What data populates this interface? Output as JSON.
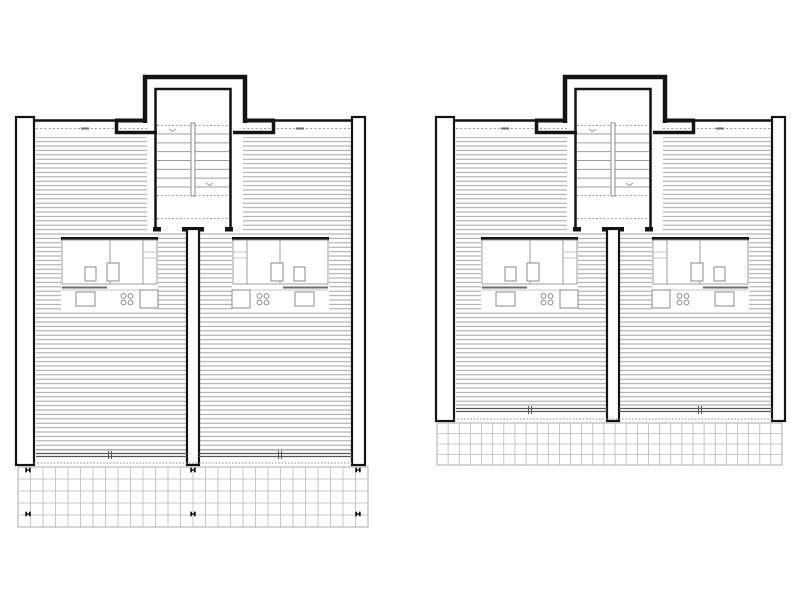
{
  "canvas": {
    "width": 800,
    "height": 600,
    "background": "#ffffff"
  },
  "colors": {
    "ink": "#141414",
    "hatch": "#989898",
    "mid": "#6e6e6e",
    "rail": "#555555",
    "light": "#c4c4c4",
    "grid": "#b9b9b9",
    "thin": "#9c9c9c",
    "fixture": "#8a8a8a",
    "white": "#ffffff"
  },
  "shared": {
    "mirror_axis": 195,
    "bar_top": 117,
    "bars": [
      {
        "x": 16,
        "w": 18
      },
      {
        "x": 352,
        "w": 13
      }
    ],
    "top_line_y": 120.5,
    "top_line_segments": [
      [
        34,
        115
      ],
      [
        275,
        352
      ]
    ],
    "shoulder": {
      "h1_y": 120.5,
      "h1": [
        [
          115,
          147
        ],
        [
          243,
          275
        ]
      ],
      "v_x": [
        116.5,
        273.5
      ],
      "v_y": [
        119,
        134
      ],
      "h2_y": 132.5,
      "h2": [
        [
          115,
          157
        ],
        [
          233,
          275
        ]
      ]
    },
    "tower": {
      "x1": 145,
      "x2": 245,
      "top": 77,
      "base": 123,
      "stroke": 4.5
    },
    "stair": {
      "x1": 155.5,
      "x2": 230.5,
      "top": 89,
      "bottom": 229,
      "tread_x1": 157,
      "tread_x2": 229,
      "tread_y1": 134,
      "tread_y2": 187,
      "treads": 7,
      "dash_y": [
        125.5,
        195.5,
        218.5
      ],
      "stringer": {
        "x": 191,
        "y": 123,
        "w": 4,
        "h": 73
      },
      "arrows": [
        [
          169,
          129
        ],
        [
          206,
          183
        ]
      ],
      "bottom_wall_y": 227,
      "bottom_wall_h": 4.5,
      "door_gaps": [
        [
          161,
          182
        ],
        [
          204,
          225
        ]
      ]
    },
    "hatch": {
      "x1": 36,
      "x2": 352,
      "top": 137,
      "spacing": 4.4
    },
    "tower_cover": {
      "x1": 147,
      "x2": 243,
      "y1": 136,
      "y2": 232
    },
    "dash_top": {
      "y": 128.5,
      "segments": [
        [
          36,
          147
        ],
        [
          243,
          352
        ]
      ],
      "ticks": [
        85,
        300
      ]
    },
    "center_wall": {
      "x": 187,
      "w": 12,
      "top": 229
    },
    "room_band": {
      "y1": 236,
      "y2": 310
    },
    "unit": {
      "block_x1": 61,
      "block_x2": 158,
      "wall_y": 237,
      "wall_h": 3.5,
      "outline": {
        "x": 62,
        "y": 240,
        "w": 95,
        "h": 44
      },
      "divider_x": 110,
      "wardrobe_x": 143,
      "shelf_y": [
        252,
        258
      ],
      "furniture": [
        {
          "x": 85,
          "y": 267,
          "w": 11,
          "h": 14
        },
        {
          "x": 107,
          "y": 263,
          "w": 12,
          "h": 18
        }
      ],
      "gray_line": {
        "x1": 62,
        "x2": 107,
        "y": 287.5
      },
      "counter_y": 290,
      "sink": {
        "x": 76,
        "y": 292,
        "w": 19,
        "h": 14
      },
      "cooktop": {
        "cx": [
          123.5,
          130.5
        ],
        "cy": [
          296,
          302.5
        ],
        "r": 2.4
      },
      "cabinet": {
        "x": 140,
        "y": 290,
        "w": 18,
        "h": 18
      }
    },
    "rail": {
      "segments": [
        [
          36,
          187
        ],
        [
          199,
          352
        ]
      ],
      "tick_x": [
        [
          108.5,
          111.5
        ],
        [
          278.5,
          281.5
        ]
      ]
    },
    "dot_line_x": [
      34,
      352
    ]
  },
  "plans": [
    {
      "name": "left-floor-plan",
      "dx": 0,
      "bar_bottom": 465,
      "hatch_bottom": 450,
      "rail_y": 453.5,
      "dot_y": 463,
      "terrace": {
        "x": 18,
        "y": 467,
        "w": 350,
        "h": 60,
        "rows": 5,
        "cols": 28
      },
      "markers": [
        [
          28,
          470
        ],
        [
          193,
          470
        ],
        [
          358,
          470
        ],
        [
          28,
          514
        ],
        [
          193,
          514
        ],
        [
          358,
          514
        ]
      ]
    },
    {
      "name": "right-floor-plan",
      "dx": 420,
      "bar_bottom": 421,
      "hatch_bottom": 405,
      "rail_y": 408.5,
      "dot_y": 419,
      "terrace": {
        "x": 437,
        "y": 423,
        "w": 345,
        "h": 42,
        "rows": 4,
        "cols": 31
      },
      "markers": []
    }
  ]
}
